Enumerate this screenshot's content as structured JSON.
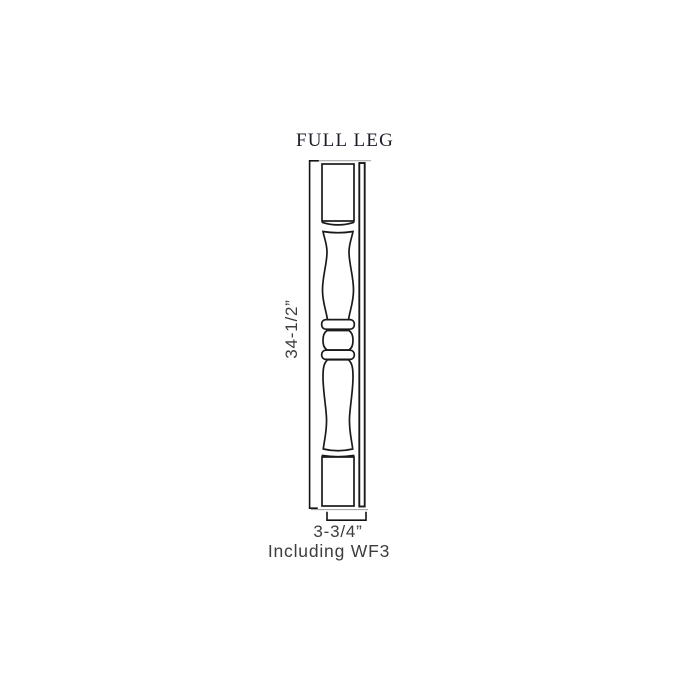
{
  "title": "FULL LEG",
  "drawing": {
    "part_name": "full-leg-elevation",
    "height_dimension": "34-1/2”",
    "width_dimension": "3-3/4”",
    "width_note": "Including WF3"
  },
  "colors": {
    "background": "#ffffff",
    "outline": "#1a1a1a",
    "dimension_line": "#141414",
    "extension_line": "#9b9b9b",
    "label_text": "#3d3d3d",
    "title_text": "#1c1c28"
  }
}
